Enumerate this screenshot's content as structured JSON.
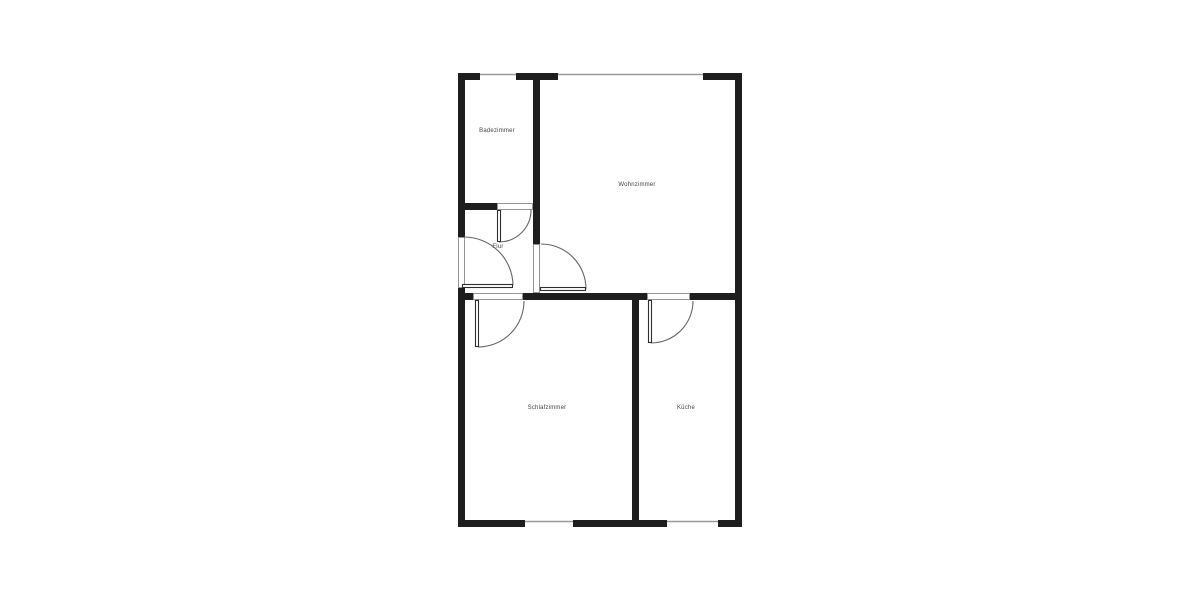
{
  "plan": {
    "title": "floor-plan",
    "colors": {
      "background": "#ffffff",
      "wall": "#1e1e1e",
      "window_line": "#999999",
      "threshold_border": "#8a8a8a",
      "leaf_border": "#2e2e2e",
      "arc": "#666666",
      "label": "#444444"
    },
    "label_font_size": 6,
    "rooms": [
      {
        "id": "badezimmer",
        "label": "Badezimmer",
        "x": 497,
        "y": 132
      },
      {
        "id": "wohnzimmer",
        "label": "Wohnzimmer",
        "x": 637,
        "y": 186
      },
      {
        "id": "flur",
        "label": "Flur",
        "x": 498,
        "y": 248
      },
      {
        "id": "schlafzimmer",
        "label": "Schlafzimmer",
        "x": 547,
        "y": 409
      },
      {
        "id": "kueche",
        "label": "Küche",
        "x": 686,
        "y": 409
      }
    ],
    "walls": [
      {
        "x": 458,
        "y": 73,
        "w": 22,
        "h": 7
      },
      {
        "x": 516,
        "y": 73,
        "w": 42,
        "h": 7
      },
      {
        "x": 703,
        "y": 73,
        "w": 39,
        "h": 7
      },
      {
        "x": 458,
        "y": 520,
        "w": 67,
        "h": 7
      },
      {
        "x": 573,
        "y": 520,
        "w": 94,
        "h": 7
      },
      {
        "x": 718,
        "y": 520,
        "w": 24,
        "h": 7
      },
      {
        "x": 458,
        "y": 73,
        "w": 7,
        "h": 164
      },
      {
        "x": 458,
        "y": 288,
        "w": 7,
        "h": 239
      },
      {
        "x": 735,
        "y": 73,
        "w": 7,
        "h": 454
      },
      {
        "x": 533,
        "y": 80,
        "w": 7,
        "h": 164
      },
      {
        "x": 465,
        "y": 203,
        "w": 32,
        "h": 7
      },
      {
        "x": 465,
        "y": 293,
        "w": 8,
        "h": 7
      },
      {
        "x": 523,
        "y": 293,
        "w": 124,
        "h": 7
      },
      {
        "x": 690,
        "y": 293,
        "w": 45,
        "h": 7
      },
      {
        "x": 632,
        "y": 300,
        "w": 7,
        "h": 220
      }
    ],
    "windows": [
      {
        "id": "window-badezimmer",
        "x1": 480,
        "y1": 74.5,
        "x2": 516,
        "y2": 74.5
      },
      {
        "id": "window-wohnzimmer",
        "x1": 558,
        "y1": 74.5,
        "x2": 703,
        "y2": 74.5
      },
      {
        "id": "window-schlafzimmer",
        "x1": 525,
        "y1": 521.5,
        "x2": 573,
        "y2": 521.5
      },
      {
        "id": "window-kueche",
        "x1": 667,
        "y1": 521.5,
        "x2": 718,
        "y2": 521.5
      }
    ],
    "door_thresholds": [
      {
        "id": "threshold-entrance",
        "x": 458,
        "y": 237,
        "w": 7,
        "h": 51
      },
      {
        "id": "threshold-badezimmer",
        "x": 497,
        "y": 203,
        "w": 36,
        "h": 7
      },
      {
        "id": "threshold-wohnzimmer",
        "x": 533,
        "y": 244,
        "w": 7,
        "h": 49
      },
      {
        "id": "threshold-schlafzimmer",
        "x": 473,
        "y": 293,
        "w": 50,
        "h": 7
      },
      {
        "id": "threshold-kueche",
        "x": 647,
        "y": 293,
        "w": 43,
        "h": 7
      }
    ],
    "door_leaves": [
      {
        "id": "leaf-entrance",
        "x": 462,
        "y": 284,
        "w": 51,
        "h": 4
      },
      {
        "id": "leaf-badezimmer",
        "x": 497,
        "y": 210,
        "w": 4,
        "h": 32
      },
      {
        "id": "leaf-wohnzimmer",
        "x": 540,
        "y": 287,
        "w": 46,
        "h": 4
      },
      {
        "id": "leaf-schlafzimmer",
        "x": 475,
        "y": 300,
        "w": 4,
        "h": 47
      },
      {
        "id": "leaf-kueche",
        "x": 648,
        "y": 300,
        "w": 4,
        "h": 43
      }
    ],
    "door_arcs": [
      {
        "id": "arc-entrance",
        "d": "M 464 237 A 49 49 0 0 1 513 285"
      },
      {
        "id": "arc-badezimmer",
        "d": "M 499 242 A 32 32 0 0 0 531 210"
      },
      {
        "id": "arc-wohnzimmer",
        "d": "M 541 244 A 45 45 0 0 1 586 289"
      },
      {
        "id": "arc-schlafzimmer",
        "d": "M 478 347 A 46 46 0 0 0 524 301"
      },
      {
        "id": "arc-kueche",
        "d": "M 651 343 A 42 42 0 0 0 693 301"
      }
    ]
  }
}
